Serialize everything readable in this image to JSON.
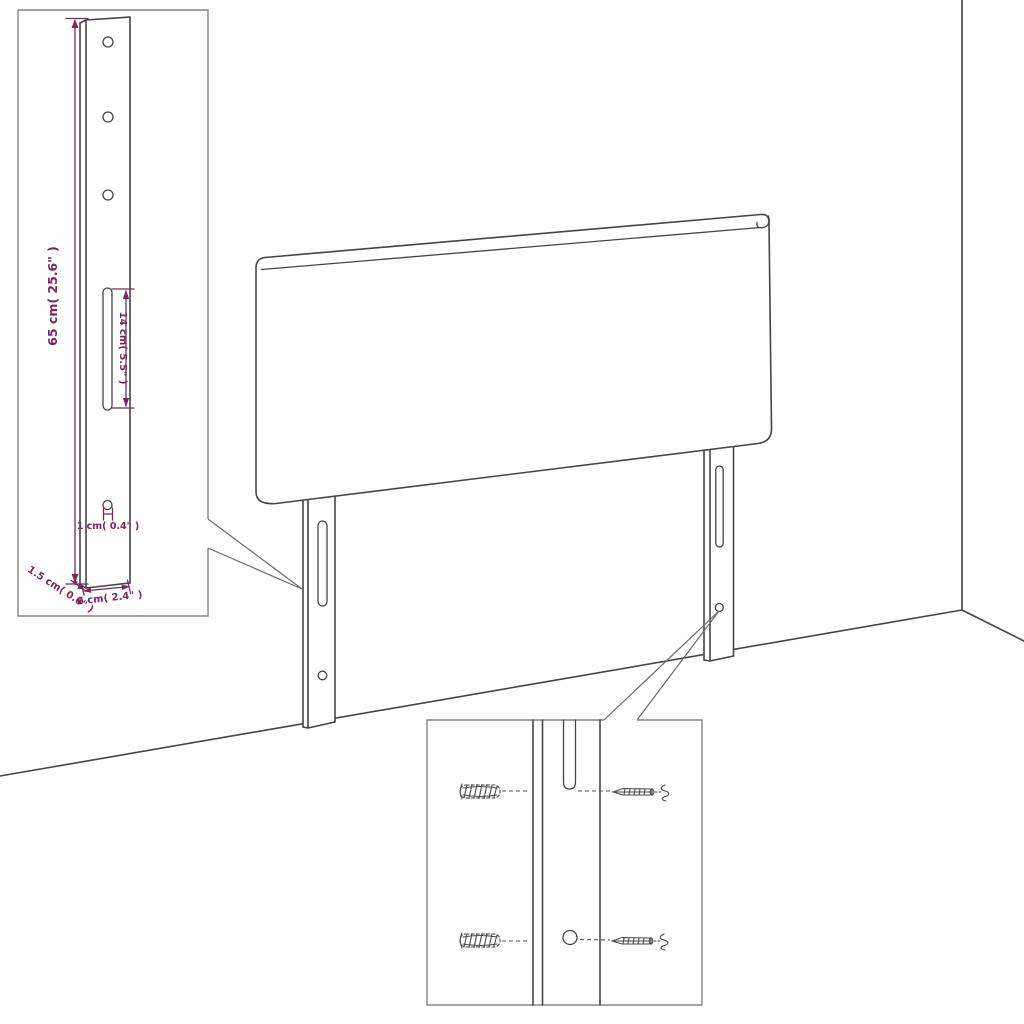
{
  "diagram": {
    "dimension_labels": {
      "leg_height": "65 cm( 25.6\" )",
      "slot_length": "14 cm( 5.5\" )",
      "hole_diameter": "1 cm( 0.4\" )",
      "leg_depth": "1.5 cm( 0.6\" )",
      "leg_width": "6 cm( 2.4\" )"
    },
    "colors": {
      "outline": "#454545",
      "dimension": "#7c265f",
      "inset_border": "#848484",
      "leader": "#6a6a6a",
      "background": "#ffffff"
    }
  }
}
